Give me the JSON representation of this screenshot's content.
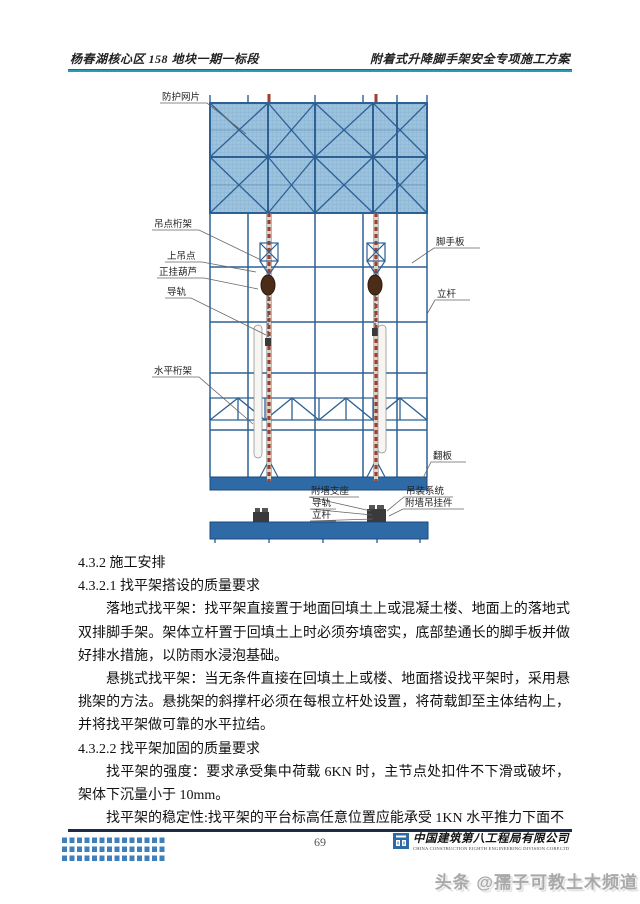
{
  "header": {
    "left": "杨春湖核心区 158 地块一期一标段",
    "right": "附着式升降脚手架安全专项施工方案"
  },
  "diagram": {
    "labels": {
      "protective_mesh": "防护网片",
      "hanging_point_truss": "吊点桁架",
      "upper_hanging_point": "上吊点",
      "hoist": "正挂葫芦",
      "guide_rail": "导轨",
      "horizontal_truss": "水平桁架",
      "scaffold_board": "脚手板",
      "vertical_pole": "立杆",
      "flip_board": "翻板",
      "wall_support": "附墙支座",
      "guide_rail_bottom": "导轨",
      "vertical_pole_bottom": "立杆",
      "hoisting_system": "吊装系统",
      "wall_hanging_part": "附墙吊挂件"
    }
  },
  "body": {
    "heading_432": "4.3.2 施工安排",
    "heading_4321": "4.3.2.1 找平架搭设的质量要求",
    "para1": "落地式找平架：找平架直接置于地面回填土上或混凝土楼、地面上的落地式双排脚手架。架体立杆置于回填土上时必须夯填密实，底部垫通长的脚手板并做好排水措施，以防雨水浸泡基础。",
    "para2": "悬挑式找平架：当无条件直接在回填土上或楼、地面搭设找平架时，采用悬挑架的方法。悬挑架的斜撑杆必须在每根立杆处设置，将荷载卸至主体结构上，并将找平架做可靠的水平拉结。",
    "heading_4322": "4.3.2.2 找平架加固的质量要求",
    "para3": "找平架的强度：要求承受集中荷载 6KN 时，主节点处扣件不下滑或破坏，架体下沉量小于 10mm。",
    "para4": "找平架的稳定性:找平架的平台标高任意位置应能承受 1KN 水平推力下面不"
  },
  "footer": {
    "page_number": "69",
    "company": "中国建筑第八工程局有限公司",
    "company_en": "CHINA CONSTRUCTION EIGHTH ENGINEERING DIVISION CORP.LTD"
  },
  "watermark": "头条 @孺子可教土木频道",
  "colors": {
    "header_rule": "#2a9ab5",
    "frame_blue": "#2d6094",
    "mesh_fill": "#9dc2dd",
    "bar_blue": "#2d6aa6",
    "mast_red": "#9e4030",
    "footer_rule": "#1d2b47",
    "watermark_gray": "#a9a9a9"
  }
}
